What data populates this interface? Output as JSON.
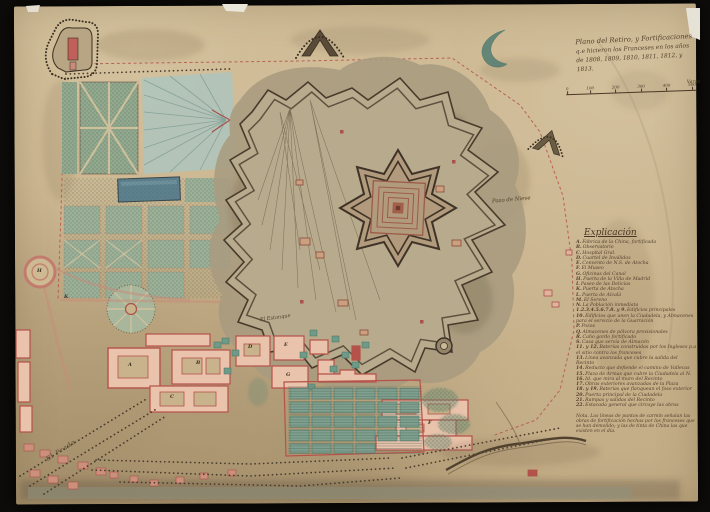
{
  "artifact": {
    "kind": "scanned manuscript map, Retiro fortifications, Madrid",
    "background_color": "#0d0c0a",
    "paper_color": "#c9b48d"
  },
  "title_block": {
    "line1": "Plano del Retiro, y Fortificaciones",
    "line2": "q.e hicieron los Franceses en los años",
    "line3": "de 1808, 1809, 1810, 1811, 1812, y 1813."
  },
  "scale_bar": {
    "tick_labels": [
      "0",
      "100",
      "200",
      "300",
      "400",
      "500"
    ],
    "unit_label": "Varas"
  },
  "legend": {
    "heading": "Explicación",
    "entries": [
      {
        "key": "A.",
        "text": "Fábrica de la China, fortificada"
      },
      {
        "key": "B.",
        "text": "Observatorio"
      },
      {
        "key": "C.",
        "text": "Hospital Gral."
      },
      {
        "key": "D.",
        "text": "Cuartel de Inválidos"
      },
      {
        "key": "E.",
        "text": "Convento de N.S. de Atocha"
      },
      {
        "key": "F.",
        "text": "El Museo"
      },
      {
        "key": "G.",
        "text": "Oficinas del Canal"
      },
      {
        "key": "H.",
        "text": "Puerta de la Villa de Madrid"
      },
      {
        "key": "I.",
        "text": "Paseo de las Delicias"
      },
      {
        "key": "K.",
        "text": "Puerta de Atocha"
      },
      {
        "key": "L.",
        "text": "Puerta de Alcalá"
      },
      {
        "key": "M.",
        "text": "El Sereno"
      },
      {
        "key": "N.",
        "text": "La Población inmediata"
      },
      {
        "key": "1.2.3.4.5.6.7.8. y 9.",
        "text": "Edificios principales"
      },
      {
        "key": "10.",
        "text": "Edificios que unen la Ciudadela, y Almacenes para el servicio de la Guarnición"
      },
      {
        "key": "P.",
        "text": "Pozos"
      },
      {
        "key": "Q.",
        "text": "Almacenes de pólvora provisionales"
      },
      {
        "key": "R.",
        "text": "Caño gordo fortificado"
      },
      {
        "key": "S.",
        "text": "Casa que servía de Almacén"
      },
      {
        "key": "11. y 12.",
        "text": "Baterías construidas por los Ingleses p.a el sitio contra los franceses"
      },
      {
        "key": "13.",
        "text": "Línea avanzada que cubre la salida del Recinto"
      },
      {
        "key": "14.",
        "text": "Reducto que defiende el camino de Vallecas"
      },
      {
        "key": "15.",
        "text": "Plaza de Armas que cubre la Ciudadela al N."
      },
      {
        "key": "16.",
        "text": "Id. que mira al muro del Recinto"
      },
      {
        "key": "17.",
        "text": "Obras exteriores avanzadas de la Plaza"
      },
      {
        "key": "18. y 19.",
        "text": "Baterías que flanquean el foso exterior"
      },
      {
        "key": "20.",
        "text": "Puerta principal de la Ciudadela"
      },
      {
        "key": "21.",
        "text": "Rampas y salidas del Recinto"
      },
      {
        "key": "22.",
        "text": "Estacada general que circuye las obras"
      }
    ],
    "nota": "Nota. Las líneas de puntos de carmín señalan las obras de fortificación hechas por los franceses que se han demolido; y las de tinta de China las que existen en el día."
  },
  "map_labels": [
    {
      "id": "pozo-de-nieve",
      "text": "Pozo de Nieve"
    },
    {
      "id": "estanque",
      "text": "El Estanque"
    },
    {
      "id": "el-prado",
      "text": "El Prado"
    }
  ],
  "building_letters": [
    "A",
    "B",
    "C",
    "D",
    "E",
    "F",
    "G",
    "K",
    "H"
  ],
  "palette": {
    "carmine": "#b5524a",
    "building_fill": "#e9c3ab",
    "garden_teal": "#93a98f",
    "pond_blue": "#5d8090",
    "ink": "#4a3b2a",
    "rampart_fill": "#b7aa8d"
  }
}
